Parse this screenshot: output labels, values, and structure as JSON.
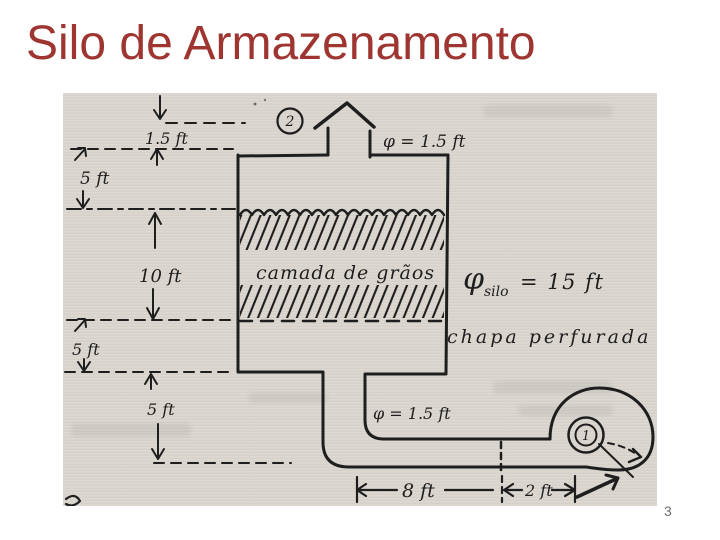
{
  "slide": {
    "title": "Silo de Armazenamento",
    "page_number": "3"
  },
  "colors": {
    "title": "#9E3530",
    "paper": "#DBD7D0",
    "ink": "#1e1e1e",
    "background": "#ffffff"
  },
  "diagram": {
    "type": "hand-drawn-silo-sketch",
    "markers": {
      "vent_point": "2",
      "blower_point": "1"
    },
    "dimensions": {
      "vent_height": "1.5 ft",
      "vent_diameter": "φ = 1.5 ft",
      "freeboard": "5 ft",
      "grain_depth": "10 ft",
      "plenum_depth": "5 ft",
      "outlet_drop": "5 ft",
      "silo_diameter_symbol": "φ",
      "silo_diameter_subscript": "silo",
      "silo_diameter_value": "= 15 ft",
      "duct_diameter": "φ = 1.5 ft",
      "duct_length": "8 ft",
      "blower_offset": "2 ft"
    },
    "annotations": {
      "grain_layer": "camada de grãos",
      "perforated_plate": "chapa perfurada"
    }
  }
}
